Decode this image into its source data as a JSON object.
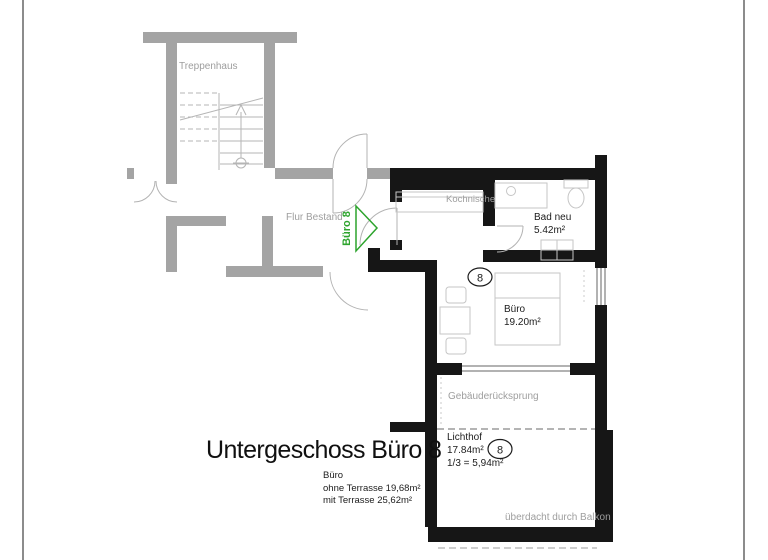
{
  "title": {
    "main": "Untergeschoss Büro 8"
  },
  "summary": {
    "room": "Büro",
    "without_terrace": "ohne Terrasse 19,68m²",
    "with_terrace": "mit Terrasse 25,62m²"
  },
  "plan": {
    "stairwell_label": "Treppenhaus",
    "corridor_label": "Flur Bestand",
    "unit_arrow_label": "Büro 8",
    "kitchenette_label": "Kochnische",
    "bathroom": {
      "name": "Bad neu",
      "area": "5.42m²"
    },
    "office": {
      "name": "Büro",
      "area": "19.20m²"
    },
    "unit_number": "8",
    "recess_label": "Gebäuderücksprung",
    "lightwell": {
      "name": "Lichthof",
      "area": "17.84m²",
      "third_share": "1/3 = 5,94m²"
    },
    "balcony_note": "überdacht durch Balkon"
  },
  "colors": {
    "existing": "#a4a4a4",
    "new": "#161616",
    "green": "#2da42d",
    "anno": "#9e9e9e",
    "fixture": "#c6c6c6"
  }
}
